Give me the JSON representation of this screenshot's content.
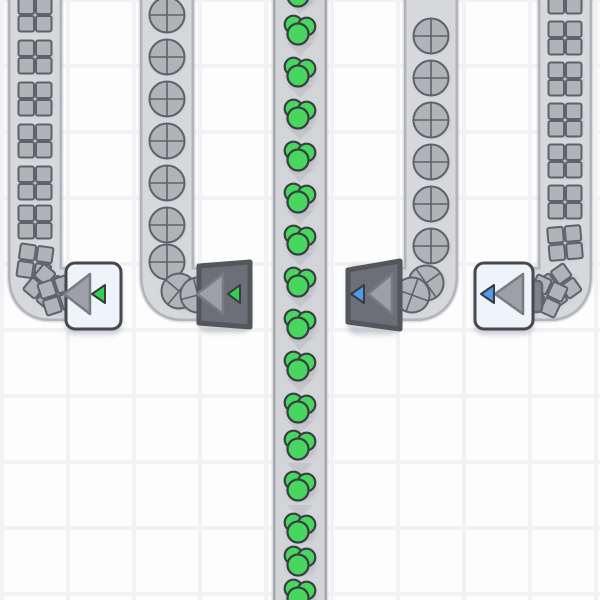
{
  "scene": {
    "width": 600,
    "height": 600,
    "description": "factory-game-belts-and-tunnels"
  },
  "palette": {
    "background": "#fdfdfe",
    "grid_line": "#f2f2f5",
    "belt_outer": "#c7c9cf",
    "belt_border": "#b2b4ba",
    "belt_surface": "#d6d8db",
    "center_belt_border": "#a7a9af",
    "center_belt_surface": "#d2d4d8",
    "belt_arrow": "#c4c6cb",
    "shape_fill": "#b1b3b7",
    "shape_stroke": "#5f626a",
    "green_fill": "#47d75e",
    "green_stroke": "#3a3d43",
    "device_dark_fill": "#6c6f76",
    "device_dark_stroke": "#53565c",
    "device_light_fill": "#eff3fa",
    "device_light_stroke": "#45484e",
    "arrow_fill": "#9da0a8",
    "arrow_stroke": "#787b82",
    "marker_green": "#2fd14e",
    "marker_blue": "#4f9be8",
    "marker_stroke": "#383b41",
    "tab_fill": "#7f828a",
    "tab_stroke": "#63666c",
    "item_shadow": "#6f7480",
    "device_shadow": "#676c78"
  },
  "grid": {
    "tile_size": 66,
    "line_width": 4,
    "vertical_line_centers": [
      2,
      68,
      134,
      200,
      266,
      332,
      398,
      464,
      530,
      596
    ],
    "horizontal_line_centers": [
      0,
      66,
      132,
      198,
      264,
      330,
      396,
      462,
      528,
      594
    ]
  },
  "belts": [
    {
      "id": "conveyor-squares-far-left",
      "item": "square",
      "cx": 35,
      "path": "M 35 -6 L 35 276 Q 35 294 50 294 L 70 294",
      "arrows_y": [],
      "items": [
        [
          35,
          15
        ],
        [
          35,
          57
        ],
        [
          35,
          99
        ],
        [
          35,
          141
        ],
        [
          35,
          183
        ],
        [
          35,
          222
        ],
        [
          35,
          262,
          8
        ],
        [
          46,
          287,
          40
        ],
        [
          58,
          295,
          72
        ]
      ]
    },
    {
      "id": "conveyor-circles-left",
      "item": "circle",
      "cx": 167,
      "path": "M 167 -6 L 167 276 Q 167 294 182 294 L 206 294",
      "arrows_y": [],
      "items": [
        [
          167,
          15
        ],
        [
          167,
          57
        ],
        [
          167,
          99
        ],
        [
          167,
          141
        ],
        [
          167,
          183
        ],
        [
          167,
          225
        ],
        [
          167,
          262
        ],
        [
          179,
          291,
          40
        ],
        [
          198,
          295,
          75
        ]
      ]
    },
    {
      "id": "conveyor-green-center",
      "item": "green",
      "cx": 300,
      "center": true,
      "path": "M 300 -6 L 300 606",
      "arrows_y": [
        7,
        49,
        91,
        133,
        175,
        217,
        259,
        301,
        343,
        385,
        427,
        469,
        511,
        553,
        595
      ],
      "items": [
        [
          300,
          -8
        ],
        [
          300,
          30
        ],
        [
          300,
          72
        ],
        [
          300,
          114
        ],
        [
          300,
          156
        ],
        [
          300,
          198
        ],
        [
          300,
          240
        ],
        [
          300,
          282
        ],
        [
          300,
          324
        ],
        [
          300,
          366
        ],
        [
          300,
          408
        ],
        [
          300,
          445
        ],
        [
          300,
          486
        ],
        [
          300,
          528
        ],
        [
          300,
          561
        ],
        [
          300,
          594
        ]
      ]
    },
    {
      "id": "conveyor-circles-right",
      "item": "circle",
      "cx": 431,
      "path": "M 431 -6 L 431 276 Q 431 294 416 294 L 398 294",
      "arrows_y": [],
      "items": [
        [
          431,
          36
        ],
        [
          431,
          78
        ],
        [
          431,
          120
        ],
        [
          431,
          162
        ],
        [
          431,
          204
        ],
        [
          431,
          246
        ],
        [
          426,
          283,
          -35
        ],
        [
          412,
          295,
          -70
        ]
      ]
    },
    {
      "id": "conveyor-squares-far-right",
      "item": "square",
      "cx": 565,
      "path": "M 565 -6 L 565 276 Q 565 294 550 294 L 531 294",
      "arrows_y": [],
      "items": [
        [
          565,
          -3
        ],
        [
          565,
          38
        ],
        [
          565,
          79
        ],
        [
          565,
          120
        ],
        [
          565,
          161
        ],
        [
          565,
          202
        ],
        [
          565,
          243,
          -5
        ],
        [
          559,
          286,
          -35
        ],
        [
          546,
          296,
          -65
        ]
      ]
    }
  ],
  "devices": [
    {
      "id": "tunnel-light-green-left",
      "style": "light",
      "body": {
        "x": 66,
        "y": 263,
        "w": 55,
        "h": 66
      },
      "arrow": {
        "apex": [
          64,
          294
        ],
        "base": [
          90,
          274,
          314
        ]
      },
      "marker": {
        "color": "green",
        "apex": [
          92,
          294
        ],
        "base": [
          105,
          285,
          303
        ]
      }
    },
    {
      "id": "tunnel-dark-green-left",
      "style": "dark",
      "body": {
        "poly": [
          [
            199,
            266
          ],
          [
            250,
            262
          ],
          [
            250,
            327
          ],
          [
            199,
            323
          ]
        ]
      },
      "arrow": {
        "apex": [
          197,
          294
        ],
        "base": [
          223,
          274,
          314
        ]
      },
      "marker": {
        "color": "green",
        "apex": [
          228,
          294
        ],
        "base": [
          240,
          285,
          303
        ]
      }
    },
    {
      "id": "tunnel-dark-blue-right",
      "style": "dark",
      "body": {
        "poly": [
          [
            348,
            270
          ],
          [
            400,
            261
          ],
          [
            400,
            329
          ],
          [
            348,
            322
          ]
        ]
      },
      "arrow": {
        "apex": [
          368,
          294
        ],
        "base": [
          392,
          274,
          314
        ]
      },
      "marker": {
        "color": "blue",
        "apex": [
          351,
          294
        ],
        "base": [
          364,
          285,
          303
        ]
      }
    },
    {
      "id": "tunnel-light-blue-right",
      "style": "light",
      "body": {
        "x": 475,
        "y": 263,
        "w": 58,
        "h": 66
      },
      "tab": {
        "x": 523,
        "y": 281,
        "w": 19,
        "h": 31
      },
      "arrow": {
        "apex": [
          495,
          294
        ],
        "base": [
          523,
          274,
          314
        ]
      },
      "marker": {
        "color": "blue",
        "apex": [
          481,
          294
        ],
        "base": [
          494,
          285,
          303
        ]
      }
    }
  ]
}
